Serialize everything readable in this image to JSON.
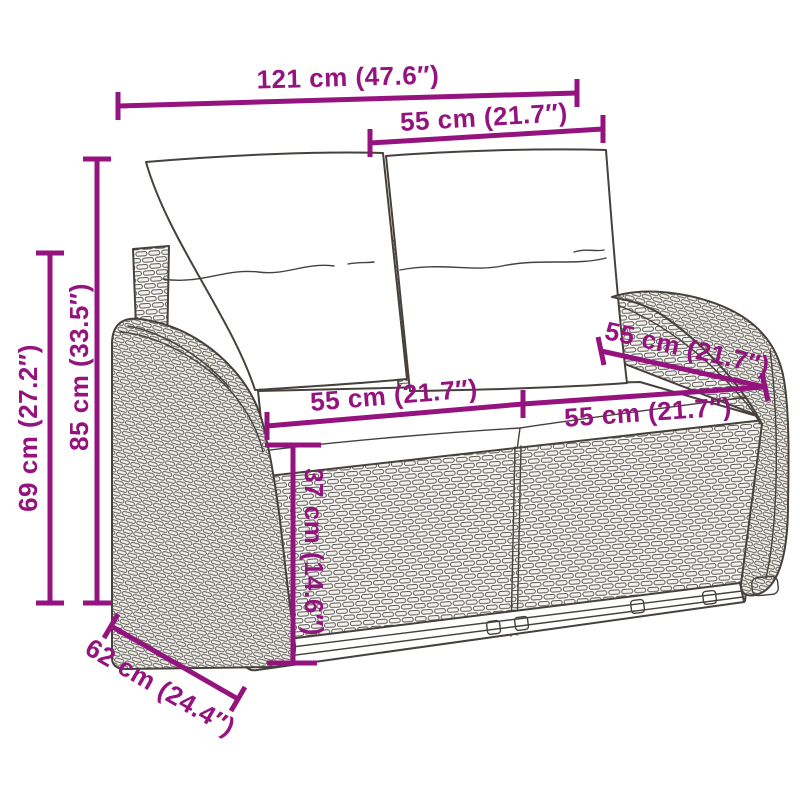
{
  "colors": {
    "accent": "#94137E",
    "line_art": "#46413C",
    "background": "#FFFFFF",
    "wicker_fill": "#F2F1EE"
  },
  "dims": {
    "total_width": "121 cm (47.6″)",
    "backrest_width": "55 cm (21.7″)",
    "overall_height": "85 cm (33.5″)",
    "armrest_height": "69 cm (27.2″)",
    "seat_width_left": "55 cm (21.7″)",
    "seat_width_right": "55 cm (21.7″)",
    "seat_depth": "55 cm (21.7″)",
    "base_height": "37 cm (14.6″)",
    "overall_depth": "62 cm (24.4″)"
  }
}
